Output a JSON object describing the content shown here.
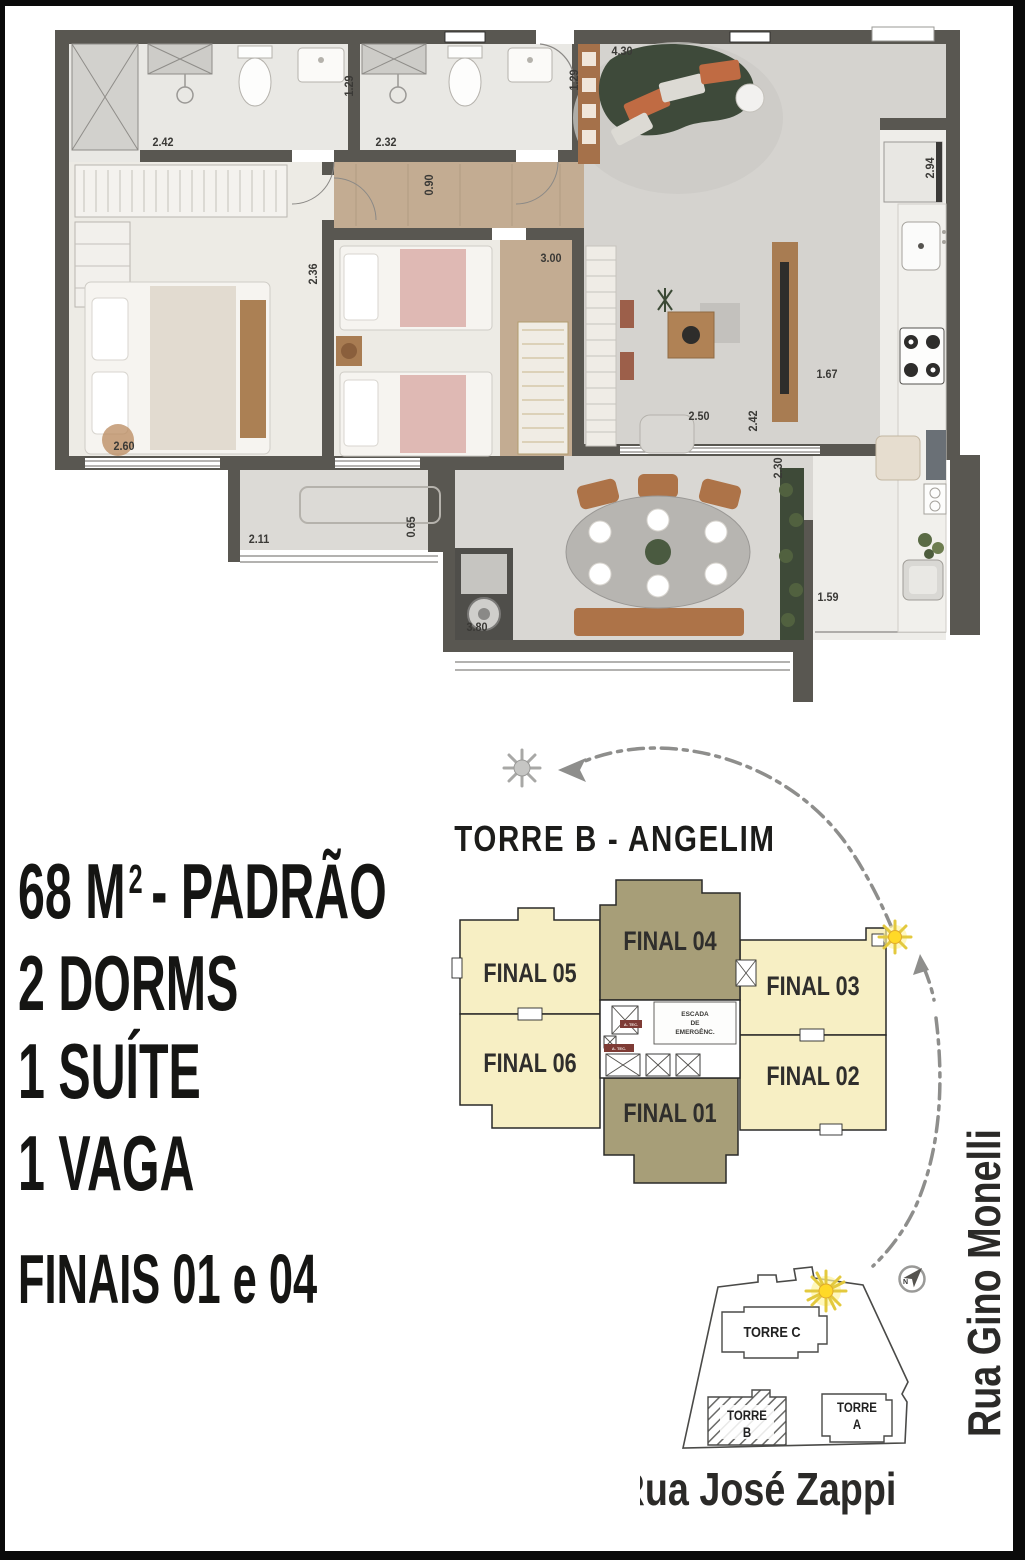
{
  "page": {
    "bg": "#ffffff",
    "frame_color": "#0a0a0a"
  },
  "colors": {
    "wall": "#595751",
    "wood_floor": "#c3ac92",
    "unit_yellow": "#f7efc4",
    "unit_highlight": "#a79e78",
    "sun_yellow": "#ffd927",
    "path_gray": "#8e8e8c",
    "sofa_green": "#3f4b3c"
  },
  "spec": {
    "area": "68 M",
    "area_sup": "2",
    "area_suffix": "- PADRÃO",
    "dorms": "2 DORMS",
    "suite": "1 SUÍTE",
    "vaga": "1 VAGA",
    "finais": "FINAIS 01 e 04"
  },
  "floor_plan": {
    "dims": [
      "2.42",
      "1.29",
      "2.32",
      "1.29",
      "0.90",
      "4.30",
      "2.94",
      "3.00",
      "2.36",
      "2.50",
      "2.42",
      "2.30",
      "1.67",
      "2.60",
      "2.11",
      "0.65",
      "3.80",
      "1.59"
    ]
  },
  "key_plan": {
    "title": "TORRE B - ANGELIM",
    "units": [
      {
        "label": "FINAL 05",
        "highlighted": false
      },
      {
        "label": "FINAL 06",
        "highlighted": false
      },
      {
        "label": "FINAL 04",
        "highlighted": true
      },
      {
        "label": "FINAL 03",
        "highlighted": false
      },
      {
        "label": "FINAL 02",
        "highlighted": false
      },
      {
        "label": "FINAL 01",
        "highlighted": true
      }
    ],
    "core": {
      "stairs_line1": "ESCADA",
      "stairs_line2": "DE",
      "stairs_line3": "EMERGÊNC.",
      "tec": "A. TEC."
    }
  },
  "site_plan": {
    "towers": {
      "c": "TORRE C",
      "b_line1": "TORRE",
      "b_line2": "B",
      "a_line1": "TORRE",
      "a_line2": "A"
    },
    "street_bottom": "Rua José Zappi",
    "street_right": "Rua Gino Monelli",
    "north": "N"
  }
}
